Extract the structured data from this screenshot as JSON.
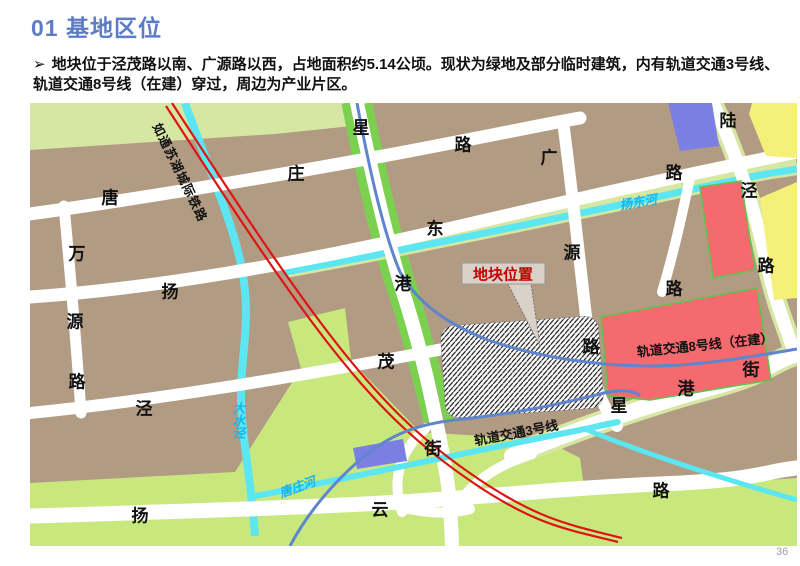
{
  "slide": {
    "title": "01 基地区位",
    "bullet_marker": "➢",
    "bullet_text": "地块位于泾茂路以南、广源路以西，占地面积约5.14公顷。现状为绿地及部分临时建筑，内有轨道交通3号线、轨道交通8号线（在建）穿过，周边为产业片区。",
    "page_number": "36"
  },
  "colors": {
    "title_blue": "#5E7BC7",
    "callout_red": "#C00000",
    "metro_blue": "#5F85CC",
    "railway_red": "#DE1414",
    "river_cyan": "#5CE6F2",
    "river_label_cyan": "#18B4EA",
    "block_brown": "#B29B83",
    "green_lime": "#C8E87E",
    "green_pale": "#D6E6A3",
    "green_bright": "#7BD14F",
    "block_red": "#F56A6E",
    "block_purple": "#7B7FE3",
    "block_yellow": "#F5F07A",
    "road_white": "#FFFFFF"
  },
  "map": {
    "callout_label": "地块位置",
    "labels": [
      {
        "t": "唐",
        "x": 110,
        "y": 196,
        "k": "road"
      },
      {
        "t": "庄",
        "x": 296,
        "y": 172,
        "k": "road"
      },
      {
        "t": "路",
        "x": 463,
        "y": 143,
        "k": "road"
      },
      {
        "t": "星",
        "x": 361,
        "y": 126,
        "k": "road"
      },
      {
        "t": "港",
        "x": 403,
        "y": 282,
        "k": "road"
      },
      {
        "t": "街",
        "x": 433,
        "y": 447,
        "k": "road"
      },
      {
        "t": "万",
        "x": 77,
        "y": 252,
        "k": "road"
      },
      {
        "t": "源",
        "x": 75,
        "y": 320,
        "k": "road"
      },
      {
        "t": "路",
        "x": 77,
        "y": 380,
        "k": "road"
      },
      {
        "t": "扬",
        "x": 170,
        "y": 290,
        "k": "road"
      },
      {
        "t": "东",
        "x": 435,
        "y": 227,
        "k": "road"
      },
      {
        "t": "路",
        "x": 674,
        "y": 171,
        "k": "road"
      },
      {
        "t": "广",
        "x": 549,
        "y": 156,
        "k": "road"
      },
      {
        "t": "源",
        "x": 572,
        "y": 251,
        "k": "road"
      },
      {
        "t": "路",
        "x": 591,
        "y": 345,
        "k": "road"
      },
      {
        "t": "泾",
        "x": 144,
        "y": 407,
        "k": "road"
      },
      {
        "t": "茂",
        "x": 386,
        "y": 360,
        "k": "road"
      },
      {
        "t": "陆",
        "x": 728,
        "y": 119,
        "k": "road"
      },
      {
        "t": "泾",
        "x": 749,
        "y": 189,
        "k": "road"
      },
      {
        "t": "路",
        "x": 766,
        "y": 264,
        "k": "road"
      },
      {
        "t": "路",
        "x": 674,
        "y": 287,
        "k": "road"
      },
      {
        "t": "星",
        "x": 619,
        "y": 404,
        "k": "road"
      },
      {
        "t": "港",
        "x": 686,
        "y": 387,
        "k": "road"
      },
      {
        "t": "街",
        "x": 751,
        "y": 368,
        "k": "road"
      },
      {
        "t": "扬",
        "x": 140,
        "y": 514,
        "k": "road"
      },
      {
        "t": "云",
        "x": 380,
        "y": 508,
        "k": "road"
      },
      {
        "t": "路",
        "x": 661,
        "y": 489,
        "k": "road"
      },
      {
        "t": "扬东河",
        "x": 638,
        "y": 201,
        "rot": -10,
        "k": "river"
      },
      {
        "t": "大水泾",
        "x": 238,
        "y": 420,
        "k": "river",
        "v": true
      },
      {
        "t": "唐庄河",
        "x": 297,
        "y": 486,
        "rot": -20,
        "k": "river"
      },
      {
        "t": "轨道交通8号线（在建）",
        "x": 705,
        "y": 344,
        "rot": -6,
        "k": "metro"
      },
      {
        "t": "轨道交通3号线",
        "x": 516,
        "y": 432,
        "rot": -11,
        "k": "metro"
      },
      {
        "t": "如通苏湖城际铁路",
        "x": 181,
        "y": 172,
        "rot": 64,
        "k": "rail"
      }
    ]
  }
}
